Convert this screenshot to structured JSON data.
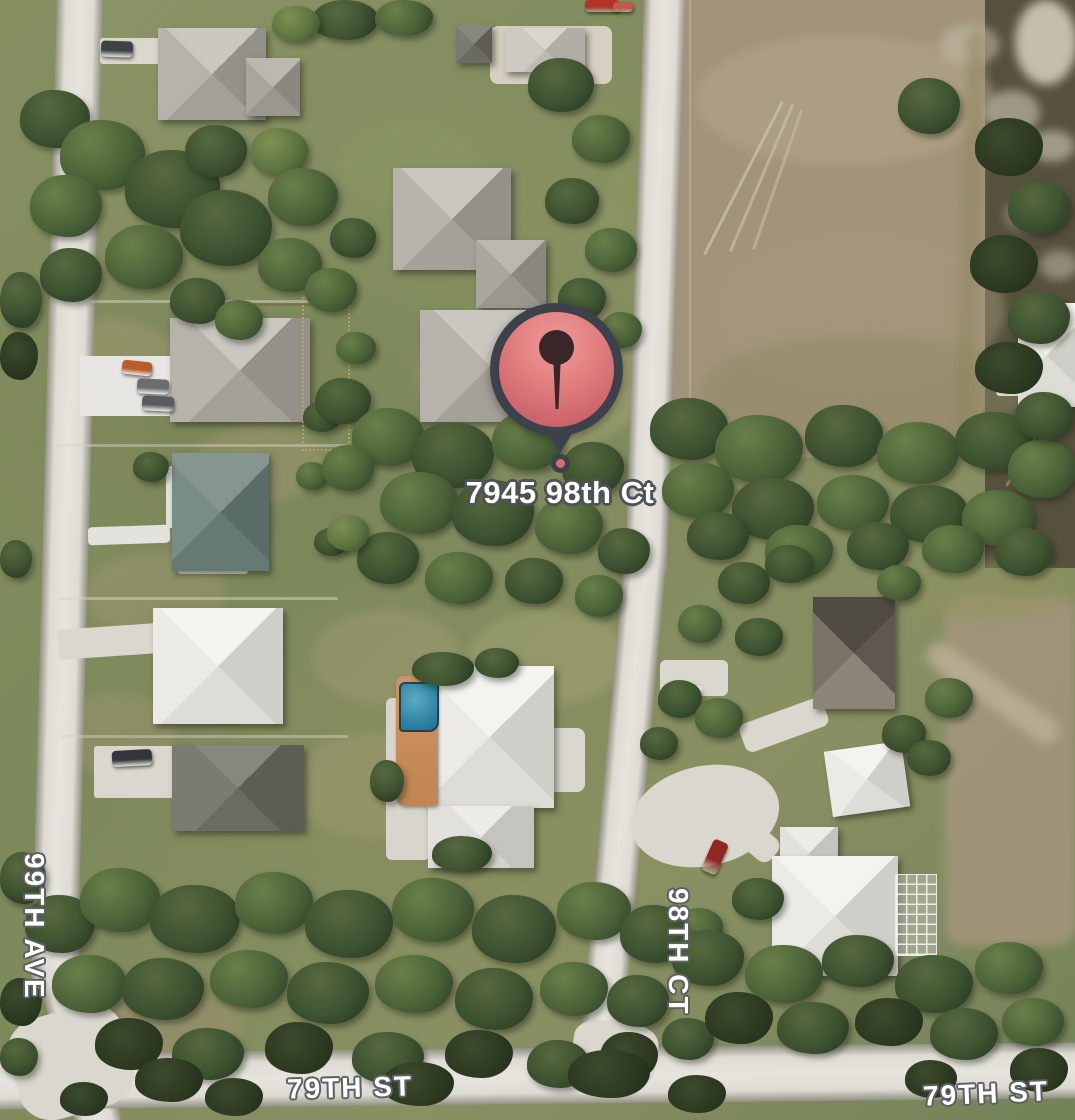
{
  "map": {
    "view": "satellite",
    "marker": {
      "label": "7945 98th Ct"
    },
    "streets": [
      {
        "label": "99TH AVE",
        "orientation": "vertical"
      },
      {
        "label": "98TH CT",
        "orientation": "vertical"
      },
      {
        "label": "79TH ST",
        "orientation": "horizontal"
      },
      {
        "label": "79TH ST",
        "orientation": "horizontal"
      }
    ],
    "colors": {
      "marker_fill": "#D96B6E",
      "marker_fill_light": "#EC9492",
      "marker_outline": "#3C414B",
      "marker_glyph": "#3A2528",
      "road": "#DEDBD4",
      "street_label_fill": "#FFFFFF",
      "street_label_outline": "#5D6062",
      "grass": "#838E60",
      "tree_dark": "#2B3D24",
      "dirt_field": "#A2947A",
      "pool_water": "#2F86A7",
      "pool_deck": "#C08552"
    }
  }
}
